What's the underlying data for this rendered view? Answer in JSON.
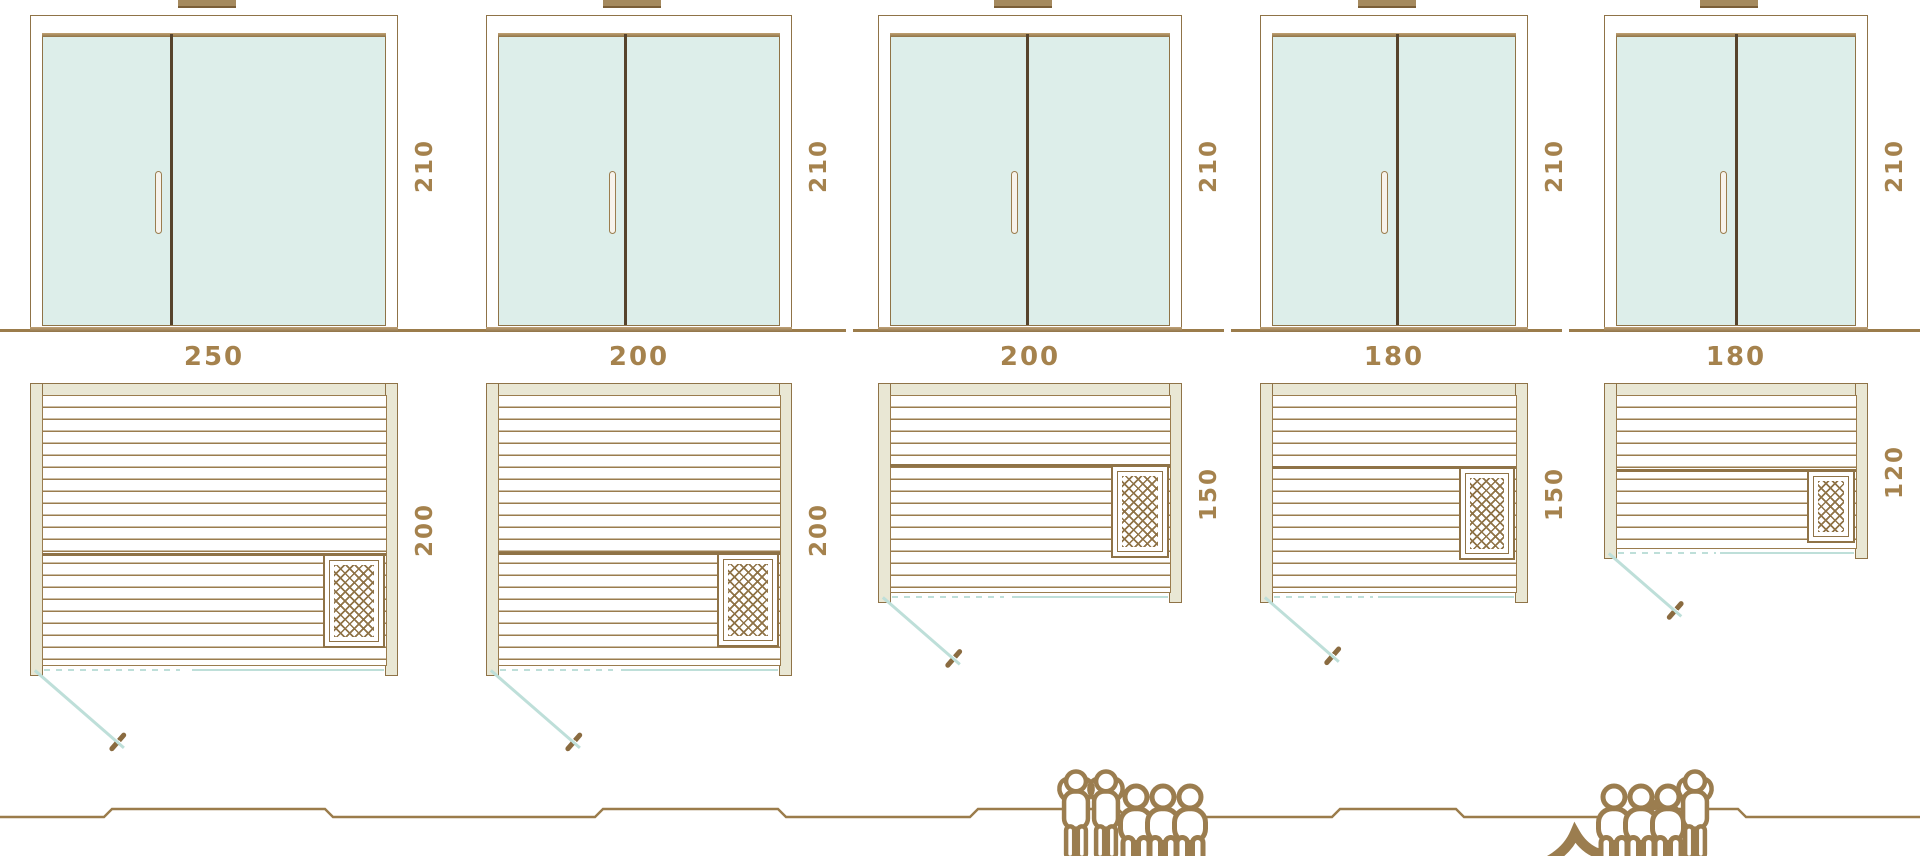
{
  "diagram_type": "sauna-model-size-comparison",
  "colors": {
    "line_brown": "#8f7347",
    "label_brown": "#a5824d",
    "wall_beige": "#e9e7d4",
    "glass_teal": "#ddeeea",
    "door_swing_teal": "#bedfd9",
    "figure_brown": "#9b7d4f"
  },
  "saunas": [
    {
      "name": "sauna-250x200",
      "width_cm": "250",
      "depth_cm": "200",
      "height_cm": "210",
      "capacity": {
        "total": 6,
        "standing": 2,
        "sitting": 3,
        "lying": 1
      },
      "figures": [
        "standing",
        "standing",
        "sitting",
        "sitting",
        "sitting",
        "lying-flip"
      ]
    },
    {
      "name": "sauna-200x200",
      "width_cm": "200",
      "depth_cm": "200",
      "height_cm": "210",
      "capacity": {
        "total": 5,
        "standing": 1,
        "sitting": 3,
        "lying": 1
      },
      "figures": [
        "lying",
        "sitting",
        "sitting",
        "sitting",
        "standing"
      ]
    },
    {
      "name": "sauna-200x150",
      "width_cm": "200",
      "depth_cm": "150",
      "height_cm": "210",
      "capacity": {
        "total": 4,
        "standing": 0,
        "sitting": 3,
        "lying": 1
      },
      "figures": [
        "lying",
        "sitting",
        "sitting",
        "sitting"
      ]
    },
    {
      "name": "sauna-180x150",
      "width_cm": "180",
      "depth_cm": "150",
      "height_cm": "210",
      "capacity": {
        "total": 3,
        "standing": 0,
        "sitting": 2,
        "lying": 1
      },
      "figures": [
        "lying",
        "sitting",
        "sitting"
      ]
    },
    {
      "name": "sauna-180x120",
      "width_cm": "180",
      "depth_cm": "120",
      "height_cm": "210",
      "capacity": {
        "total": 2,
        "standing": 0,
        "sitting": 1,
        "lying": 1
      },
      "figures": [
        "lying",
        "sitting"
      ]
    }
  ]
}
